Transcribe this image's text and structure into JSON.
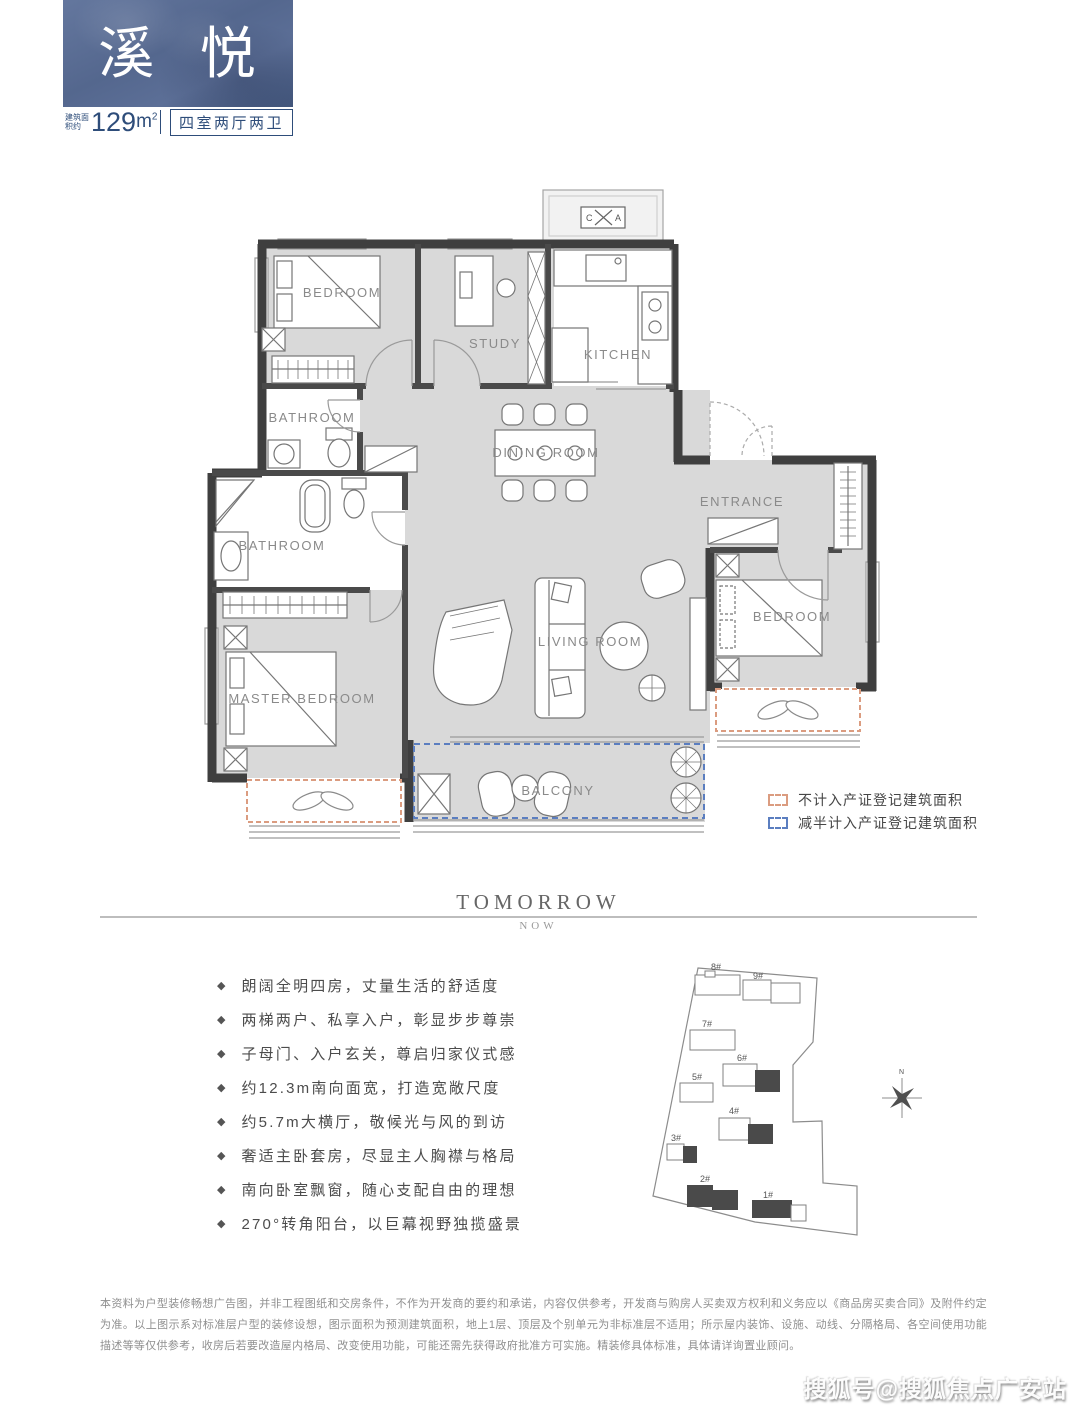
{
  "header": {
    "title": "溪 悦",
    "area_label": "建筑面积约",
    "area_value": "129",
    "area_unit": "m",
    "area_exp": "2",
    "layout_spec": "四室两厅两卫"
  },
  "floorplan": {
    "rooms": {
      "bedroom_top": "BEDROOM",
      "study": "STUDY",
      "kitchen": "KITCHEN",
      "bathroom_upper": "BATHROOM",
      "dining": "DINING ROOM",
      "entrance": "ENTRANCE",
      "bathroom_lower": "BATHROOM",
      "living": "LIVING ROOM",
      "bedroom_right": "BEDROOM",
      "master": "MASTER BEDROOM",
      "balcony": "BALCONY"
    },
    "ac_box": {
      "left": "C",
      "right": "A"
    },
    "legend": {
      "items": [
        {
          "label": "不计入产证登记建筑面积",
          "color": "#DB9C80"
        },
        {
          "label": "减半计入产证登记建筑面积",
          "color": "#5B7EC0"
        }
      ]
    }
  },
  "divider": {
    "primary": "TOMORROW",
    "secondary": "NOW"
  },
  "features": {
    "bullet": "◆",
    "items": [
      "朗阔全明四房，丈量生活的舒适度",
      "两梯两户、私享入户，彰显步步尊崇",
      "子母门、入户玄关，尊启归家仪式感",
      "约12.3m南向面宽，打造宽敞尺度",
      "约5.7m大横厅，敬候光与风的到访",
      "奢适主卧套房，尽显主人胸襟与格局",
      "南向卧室飘窗，随心支配自由的理想",
      "270°转角阳台，以巨幕视野独揽盛景"
    ]
  },
  "site": {
    "buildings": [
      {
        "label": "1#"
      },
      {
        "label": "2#"
      },
      {
        "label": "3#"
      },
      {
        "label": "4#"
      },
      {
        "label": "5#"
      },
      {
        "label": "6#"
      },
      {
        "label": "7#"
      },
      {
        "label": "8#"
      },
      {
        "label": "9#"
      }
    ],
    "compass": "N"
  },
  "disclaimer": "本资料为户型装修畅想广告图，并非工程图纸和交房条件，不作为开发商的要约和承诺，内容仅供参考，开发商与购房人买卖双方权利和义务应以《商品房买卖合同》及附件约定为准。以上图示系对标准层户型的装修设想，图示面积为预测建筑面积，地上1层、顶层及个别单元为非标准层不适用；所示屋内装饰、设施、动线、分隔格局、各空间使用功能描述等等仅供参考，收房后若要改造屋内格局、改变使用功能，可能还需先获得政府批准方可实施。精装修具体标准，具体请详询置业顾问。",
  "watermark": "搜狐号@搜狐焦点广安站"
}
